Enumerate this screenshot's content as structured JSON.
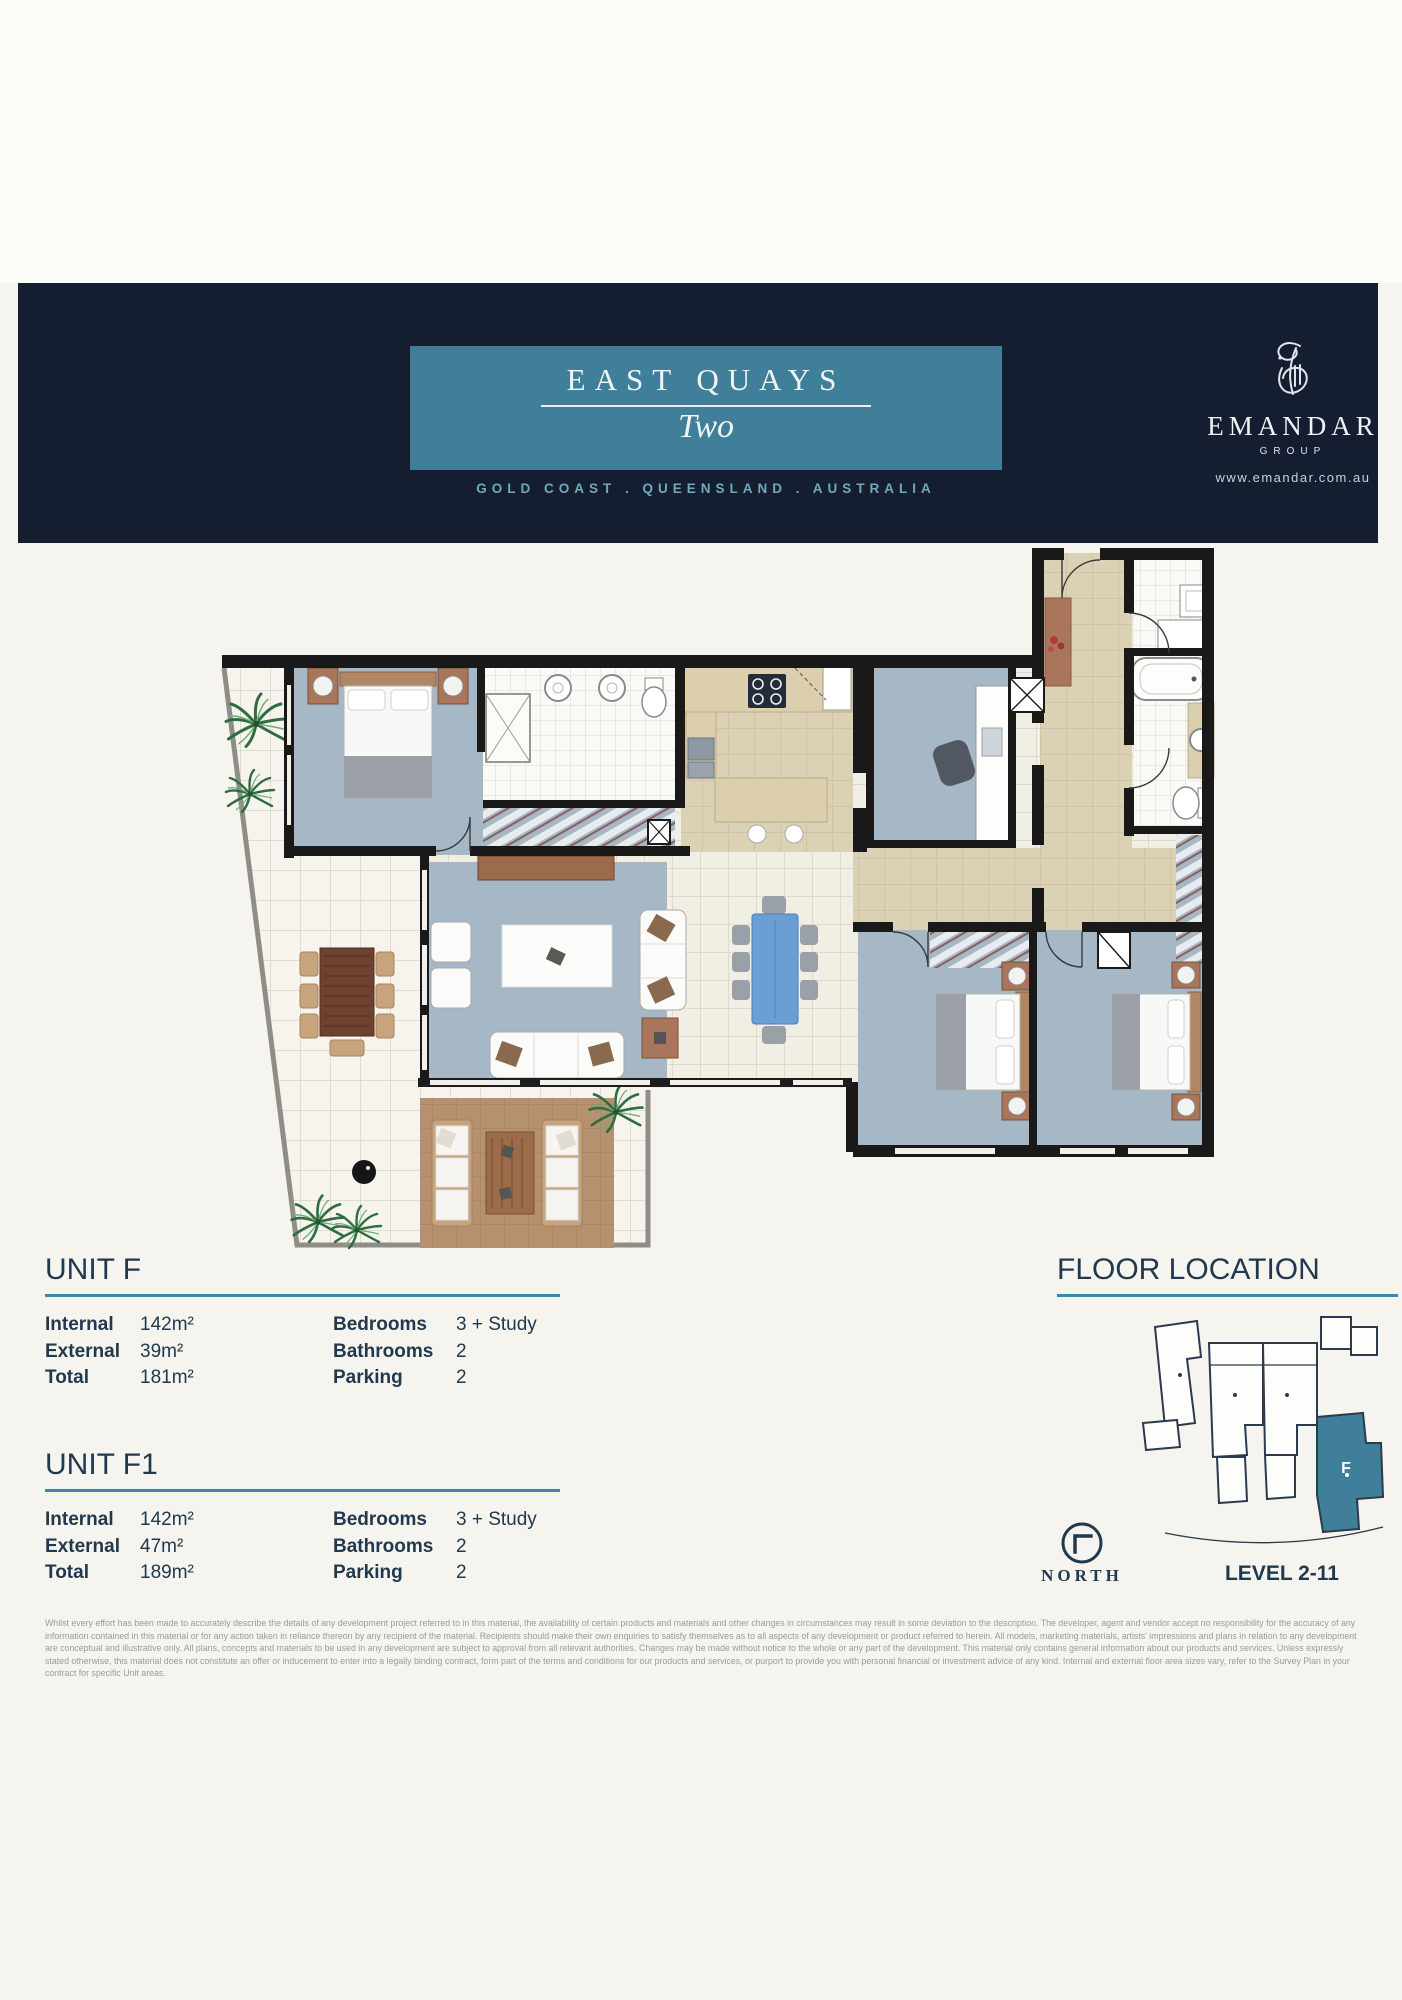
{
  "banner": {
    "title": "EAST QUAYS",
    "subtitle": "Two",
    "location_line": "GOLD COAST . QUEENSLAND . AUSTRALIA",
    "logo": {
      "name": "EMANDAR",
      "group_label": "GROUP",
      "website": "www.emandar.com.au"
    },
    "colors": {
      "navy": "#151e30",
      "teal": "#3f7f99",
      "location_text": "#6ea9bf",
      "rule": "#3e87a8"
    }
  },
  "units": [
    {
      "heading": "UNIT F",
      "left_specs": [
        {
          "label": "Internal",
          "value": "142m²"
        },
        {
          "label": "External",
          "value": "39m²"
        },
        {
          "label": "Total",
          "value": "181m²"
        }
      ],
      "right_specs": [
        {
          "label": "Bedrooms",
          "value": "3 + Study"
        },
        {
          "label": "Bathrooms",
          "value": "2"
        },
        {
          "label": "Parking",
          "value": "2"
        }
      ]
    },
    {
      "heading": "UNIT F1",
      "left_specs": [
        {
          "label": "Internal",
          "value": "142m²"
        },
        {
          "label": "External",
          "value": "47m²"
        },
        {
          "label": "Total",
          "value": "189m²"
        }
      ],
      "right_specs": [
        {
          "label": "Bedrooms",
          "value": "3 + Study"
        },
        {
          "label": "Bathrooms",
          "value": "2"
        },
        {
          "label": "Parking",
          "value": "2"
        }
      ]
    }
  ],
  "floor_location": {
    "heading": "FLOOR LOCATION",
    "unit_letter": "F",
    "level_label": "LEVEL 2-11",
    "north_label": "NORTH",
    "highlight_color": "#3f7f99"
  },
  "disclaimer": "Whilst every effort has been made to accurately describe the details of any development project referred to in this material, the availability of certain products and materials and other changes in circumstances may result in some deviation to the description. The developer, agent and vendor accept no responsibility for the accuracy of any information contained in this material or for any action taken in reliance thereon by any recipient of the material. Recipients should make their own enquiries to satisfy themselves as to all aspects of any development or product referred to herein. All models, marketing materials, artists' impressions and plans in relation to any development are conceptual and illustrative only. All plans, concepts and materials to be used in any development are subject to approval from all relevant authorities. Changes may be made without notice to the whole or any part of the development. This material only contains general information about our products and services. Unless expressly stated otherwise, this material does not constitute an offer or inducement to enter into a legally binding contract, form part of the terms and conditions for our products and services, or purport to provide you with personal financial or investment advice of any kind. Internal and external floor area sizes vary, refer to the Survey Plan in your contract for specific Unit areas."
}
